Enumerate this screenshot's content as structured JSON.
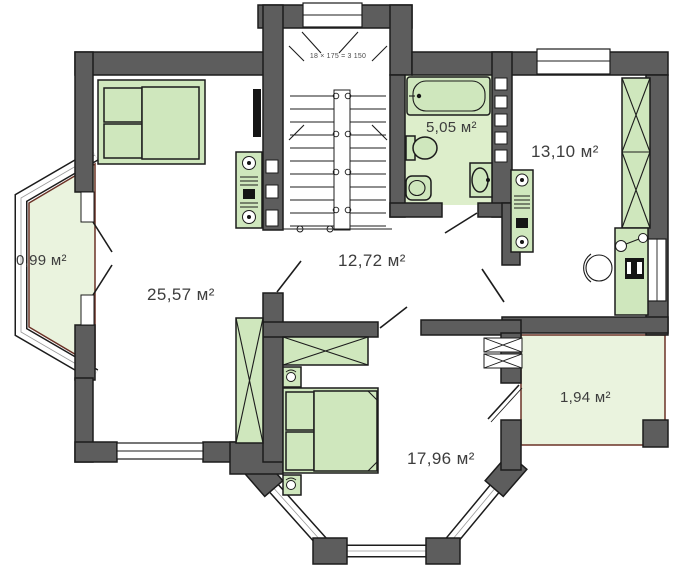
{
  "title": "Floor plan with room areas",
  "rooms": {
    "balcony_left": {
      "area_label": "0,99 м²"
    },
    "bedroom_left": {
      "area_label": "25,57 м²"
    },
    "hall": {
      "area_label": "12,72 м²"
    },
    "bathroom": {
      "area_label": "5,05 м²"
    },
    "room_top_right": {
      "area_label": "13,10 м²"
    },
    "balcony_right": {
      "area_label": "1,94 м²"
    },
    "bedroom_bottom": {
      "area_label": "17,96 м²"
    }
  },
  "staircase": {
    "dimension_note": "18 × 175 = 3 150"
  },
  "colors": {
    "wall": "#5d5d5d",
    "line": "#1c1c1c",
    "furniture": "#cfe7bd",
    "bathroom_floor": "#ddeecb",
    "balcony_floor": "#eaf3de",
    "accent_red": "#6b3226",
    "label_text": "#3d3d3d"
  }
}
